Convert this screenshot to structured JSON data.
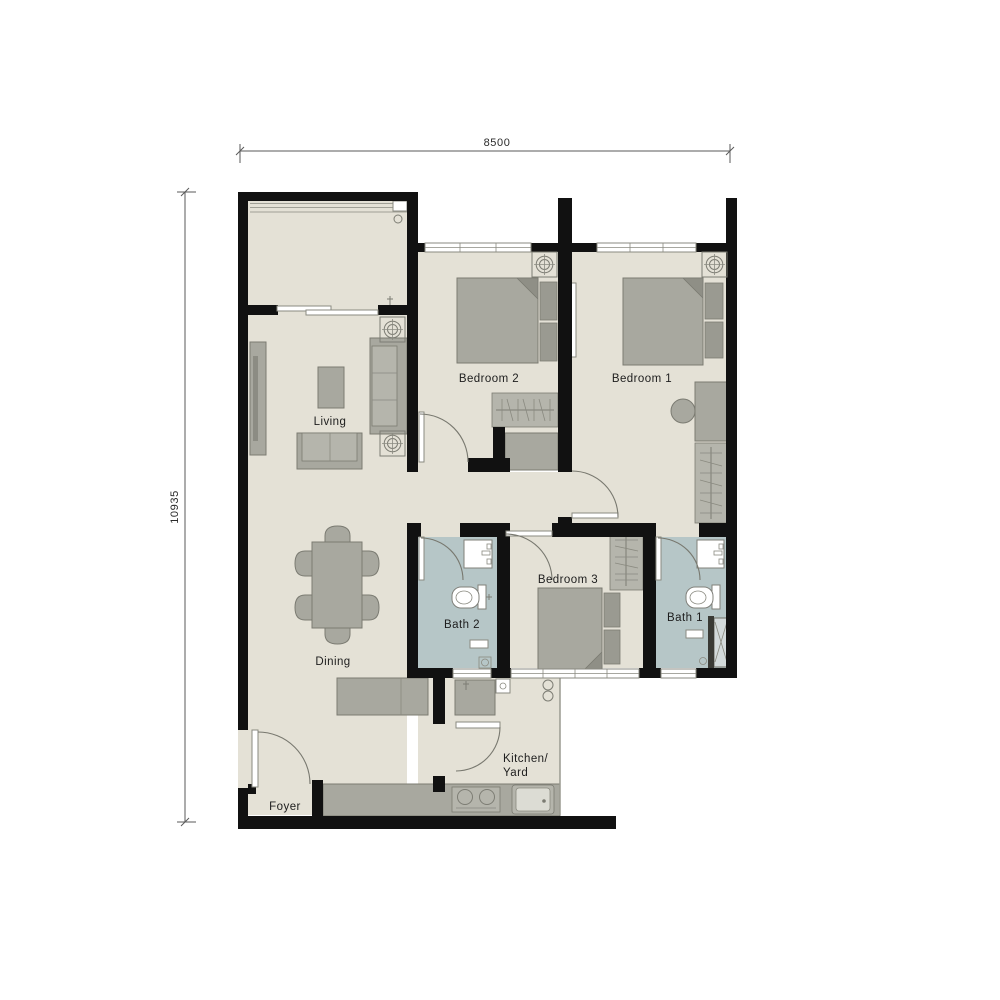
{
  "title": "3-bedroom apartment floor plan",
  "dimensions": {
    "width_label": "8500",
    "height_label": "10935"
  },
  "rooms": {
    "living": {
      "label": "Living"
    },
    "dining": {
      "label": "Dining"
    },
    "foyer": {
      "label": "Foyer"
    },
    "kitchen": {
      "label_line1": "Kitchen/",
      "label_line2": "Yard"
    },
    "bedroom1": {
      "label": "Bedroom 1"
    },
    "bedroom2": {
      "label": "Bedroom 2"
    },
    "bedroom3": {
      "label": "Bedroom 3"
    },
    "bath1": {
      "label": "Bath 1"
    },
    "bath2": {
      "label": "Bath 2"
    }
  },
  "colors": {
    "background": "#ffffff",
    "wall": "#111111",
    "floor": "#e4e1d6",
    "bath_floor": "#b6c6c7",
    "furniture": "#a8a89f",
    "furniture_dark": "#8f8f86",
    "outline": "#7b7b72",
    "text": "#1d1d1d",
    "dimension_line": "#5a5a5a"
  },
  "icons": {
    "ac_unit": "ac-ceiling-unit-icon",
    "door_swing": "door-swing-arc-icon",
    "window": "window-band-icon",
    "sliding_door": "sliding-door-icon",
    "wardrobe": "wardrobe-hangers-icon",
    "toilet": "toilet-icon",
    "sink": "sink-icon",
    "shower": "shower-enclosure-icon",
    "stove": "stove-burners-icon",
    "kitchen_sink": "kitchen-sink-icon",
    "floor_drain": "floor-drain-icon",
    "washer_point": "washer-point-icon"
  }
}
